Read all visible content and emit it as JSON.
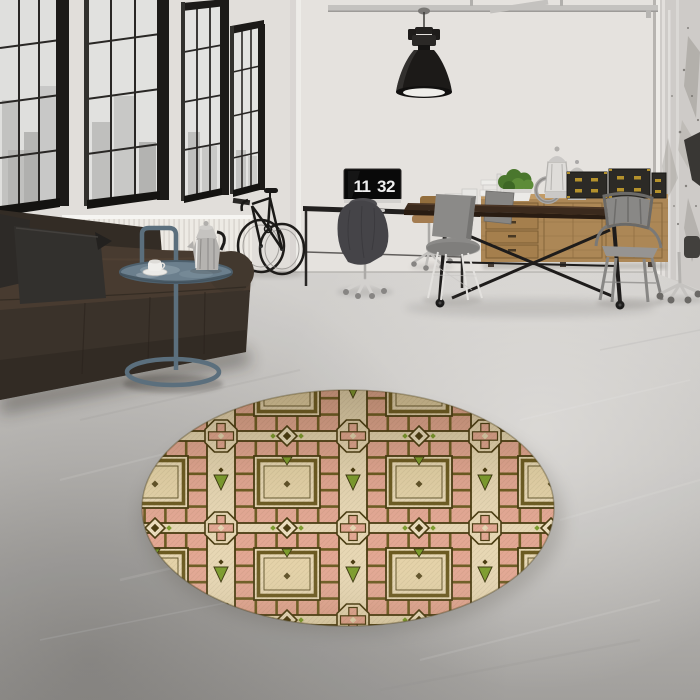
{
  "meta": {
    "type": "interior-photograph",
    "description": "Industrial loft living room with tall black-framed windows, leather sofa, bicycle, desk with flip-clock monitor, wooden sideboard, dining table with metal chairs, pendant lamp, and a round geometric rug on a concrete floor"
  },
  "clock": {
    "hours": "11",
    "minutes": "32"
  },
  "objects": {
    "window": "black steel factory window with city view",
    "radiator": "white ribbed wall radiator",
    "sofa": "dark brown leather chaise sofa with two grey pillows",
    "side_table": "steel-blue tray side table with moka pot and coffee cup",
    "bicycle": "black bicycle leaning on wall rack",
    "pendant_lamp": "black industrial dome pendant lamp",
    "monitor_clock": "monitor showing flip clock",
    "office_chairs": "swivel office chairs, one with grey jacket draped",
    "sideboard": "oak campaign sideboard with drawers",
    "storage_boxes": "black chests with brass hardware",
    "plant": "green plant in white pot",
    "lanterns": "white candle lanterns and ring",
    "dining_table": "dark wood industrial table with X trestle and casters",
    "shell_chairs": "grey molded shell chairs",
    "tolix_chair": "grey steel armchair",
    "column": "distressed concrete column",
    "rug": "round cream, pink, olive and green geometric rug"
  },
  "palette": {
    "wall": "#e8e5e1",
    "floor_light": "#d8d6d3",
    "floor_dark": "#a5a3a0",
    "window_frame": "#1d1b19",
    "sofa": "#3c332b",
    "pillow": "#2e2b28",
    "side_table": "#5d7280",
    "radiator": "#f2efe9",
    "lamp": "#1d1b19",
    "desk": "#232120",
    "sideboard": "#b08a58",
    "box": "#2d2b27",
    "box_brass": "#c9a12e",
    "plant": "#4c7a2e",
    "table_top": "#3d2b1e",
    "chair_grey": "#8e8d8b",
    "rug_cream": "#ecdcb8",
    "rug_pink": "#e8ab96",
    "rug_olive": "#6f5d22",
    "rug_dark": "#4a3c10",
    "rug_green": "#7fa12e"
  }
}
